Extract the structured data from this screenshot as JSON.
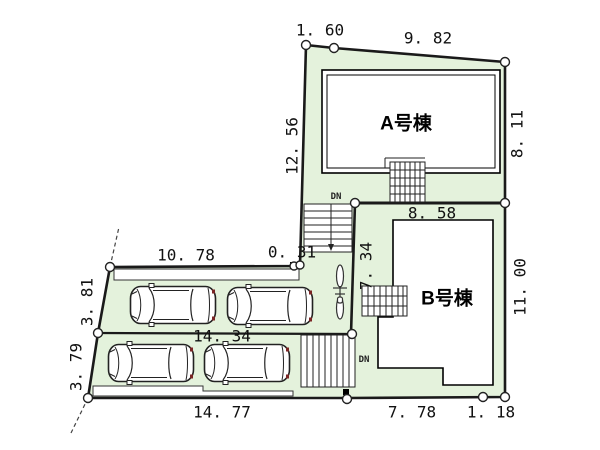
{
  "buildings": {
    "a_label": "A号棟",
    "b_label": "B号棟"
  },
  "stairs": {
    "upper_dn": "DN",
    "lower_dn": "DN"
  },
  "dimensions": {
    "a_top_offset": "1. 60",
    "a_top": "9. 82",
    "a_left": "12. 56",
    "a_right": "8. 11",
    "ab_boundary": "8. 58",
    "b_left": "7. 34",
    "b_right": "11. 00",
    "parking_top": "10. 78",
    "parking_top_gap": "0. 31",
    "west_upper": "3. 81",
    "west_lower": "3. 79",
    "parking_mid": "14. 34",
    "south_west": "14. 77",
    "south_b": "7. 78",
    "south_corner": "1. 18"
  },
  "parking": {
    "car_count": 4,
    "bicycle_count": 1
  },
  "icons": {
    "car": "car-icon",
    "bicycle": "bicycle-icon",
    "survey_point": "survey-point-circle",
    "stairs": "stairs-symbol"
  },
  "colors": {
    "plot_fill": "#E4F2DC",
    "line": "#1A1A1A",
    "text": "#111111",
    "car_outline": "#222222"
  }
}
